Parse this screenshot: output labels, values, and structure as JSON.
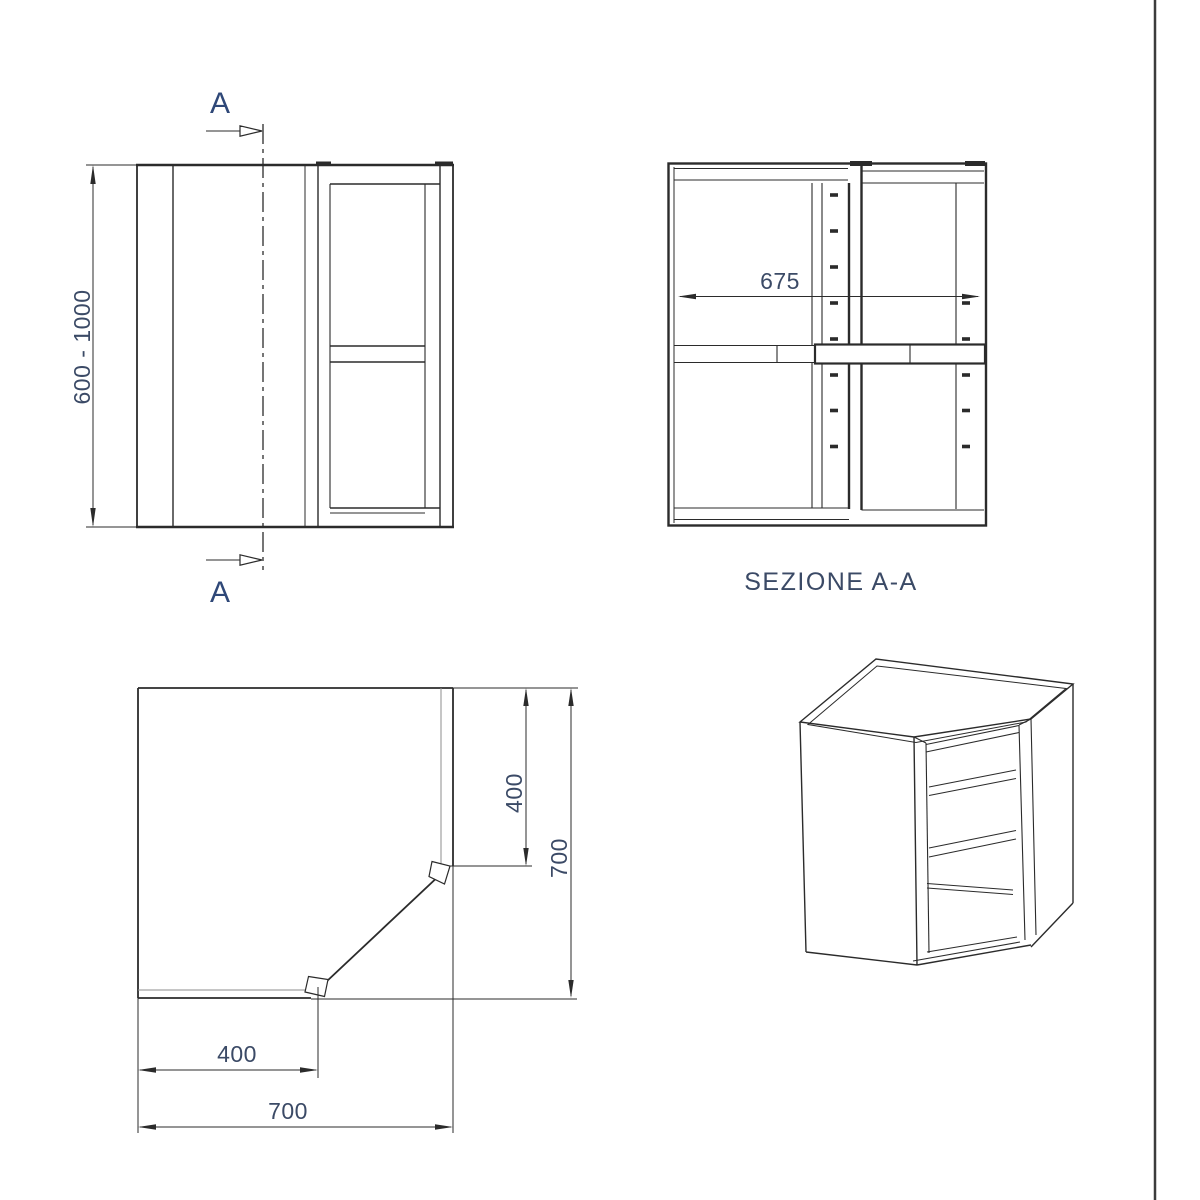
{
  "colors": {
    "line": "#2b2b2b",
    "dim_text": "#3b4a66",
    "section_letter": "#2f4878",
    "border": "#3c3c3c",
    "bg": "#ffffff"
  },
  "front_view": {
    "section_label": "A",
    "height_dim": "600 - 1000"
  },
  "section_view": {
    "title": "SEZIONE A-A",
    "width_dim": "675"
  },
  "plan_view": {
    "door_depth_dim": "400",
    "total_depth_dim": "700",
    "door_width_dim": "400",
    "total_width_dim": "700"
  }
}
